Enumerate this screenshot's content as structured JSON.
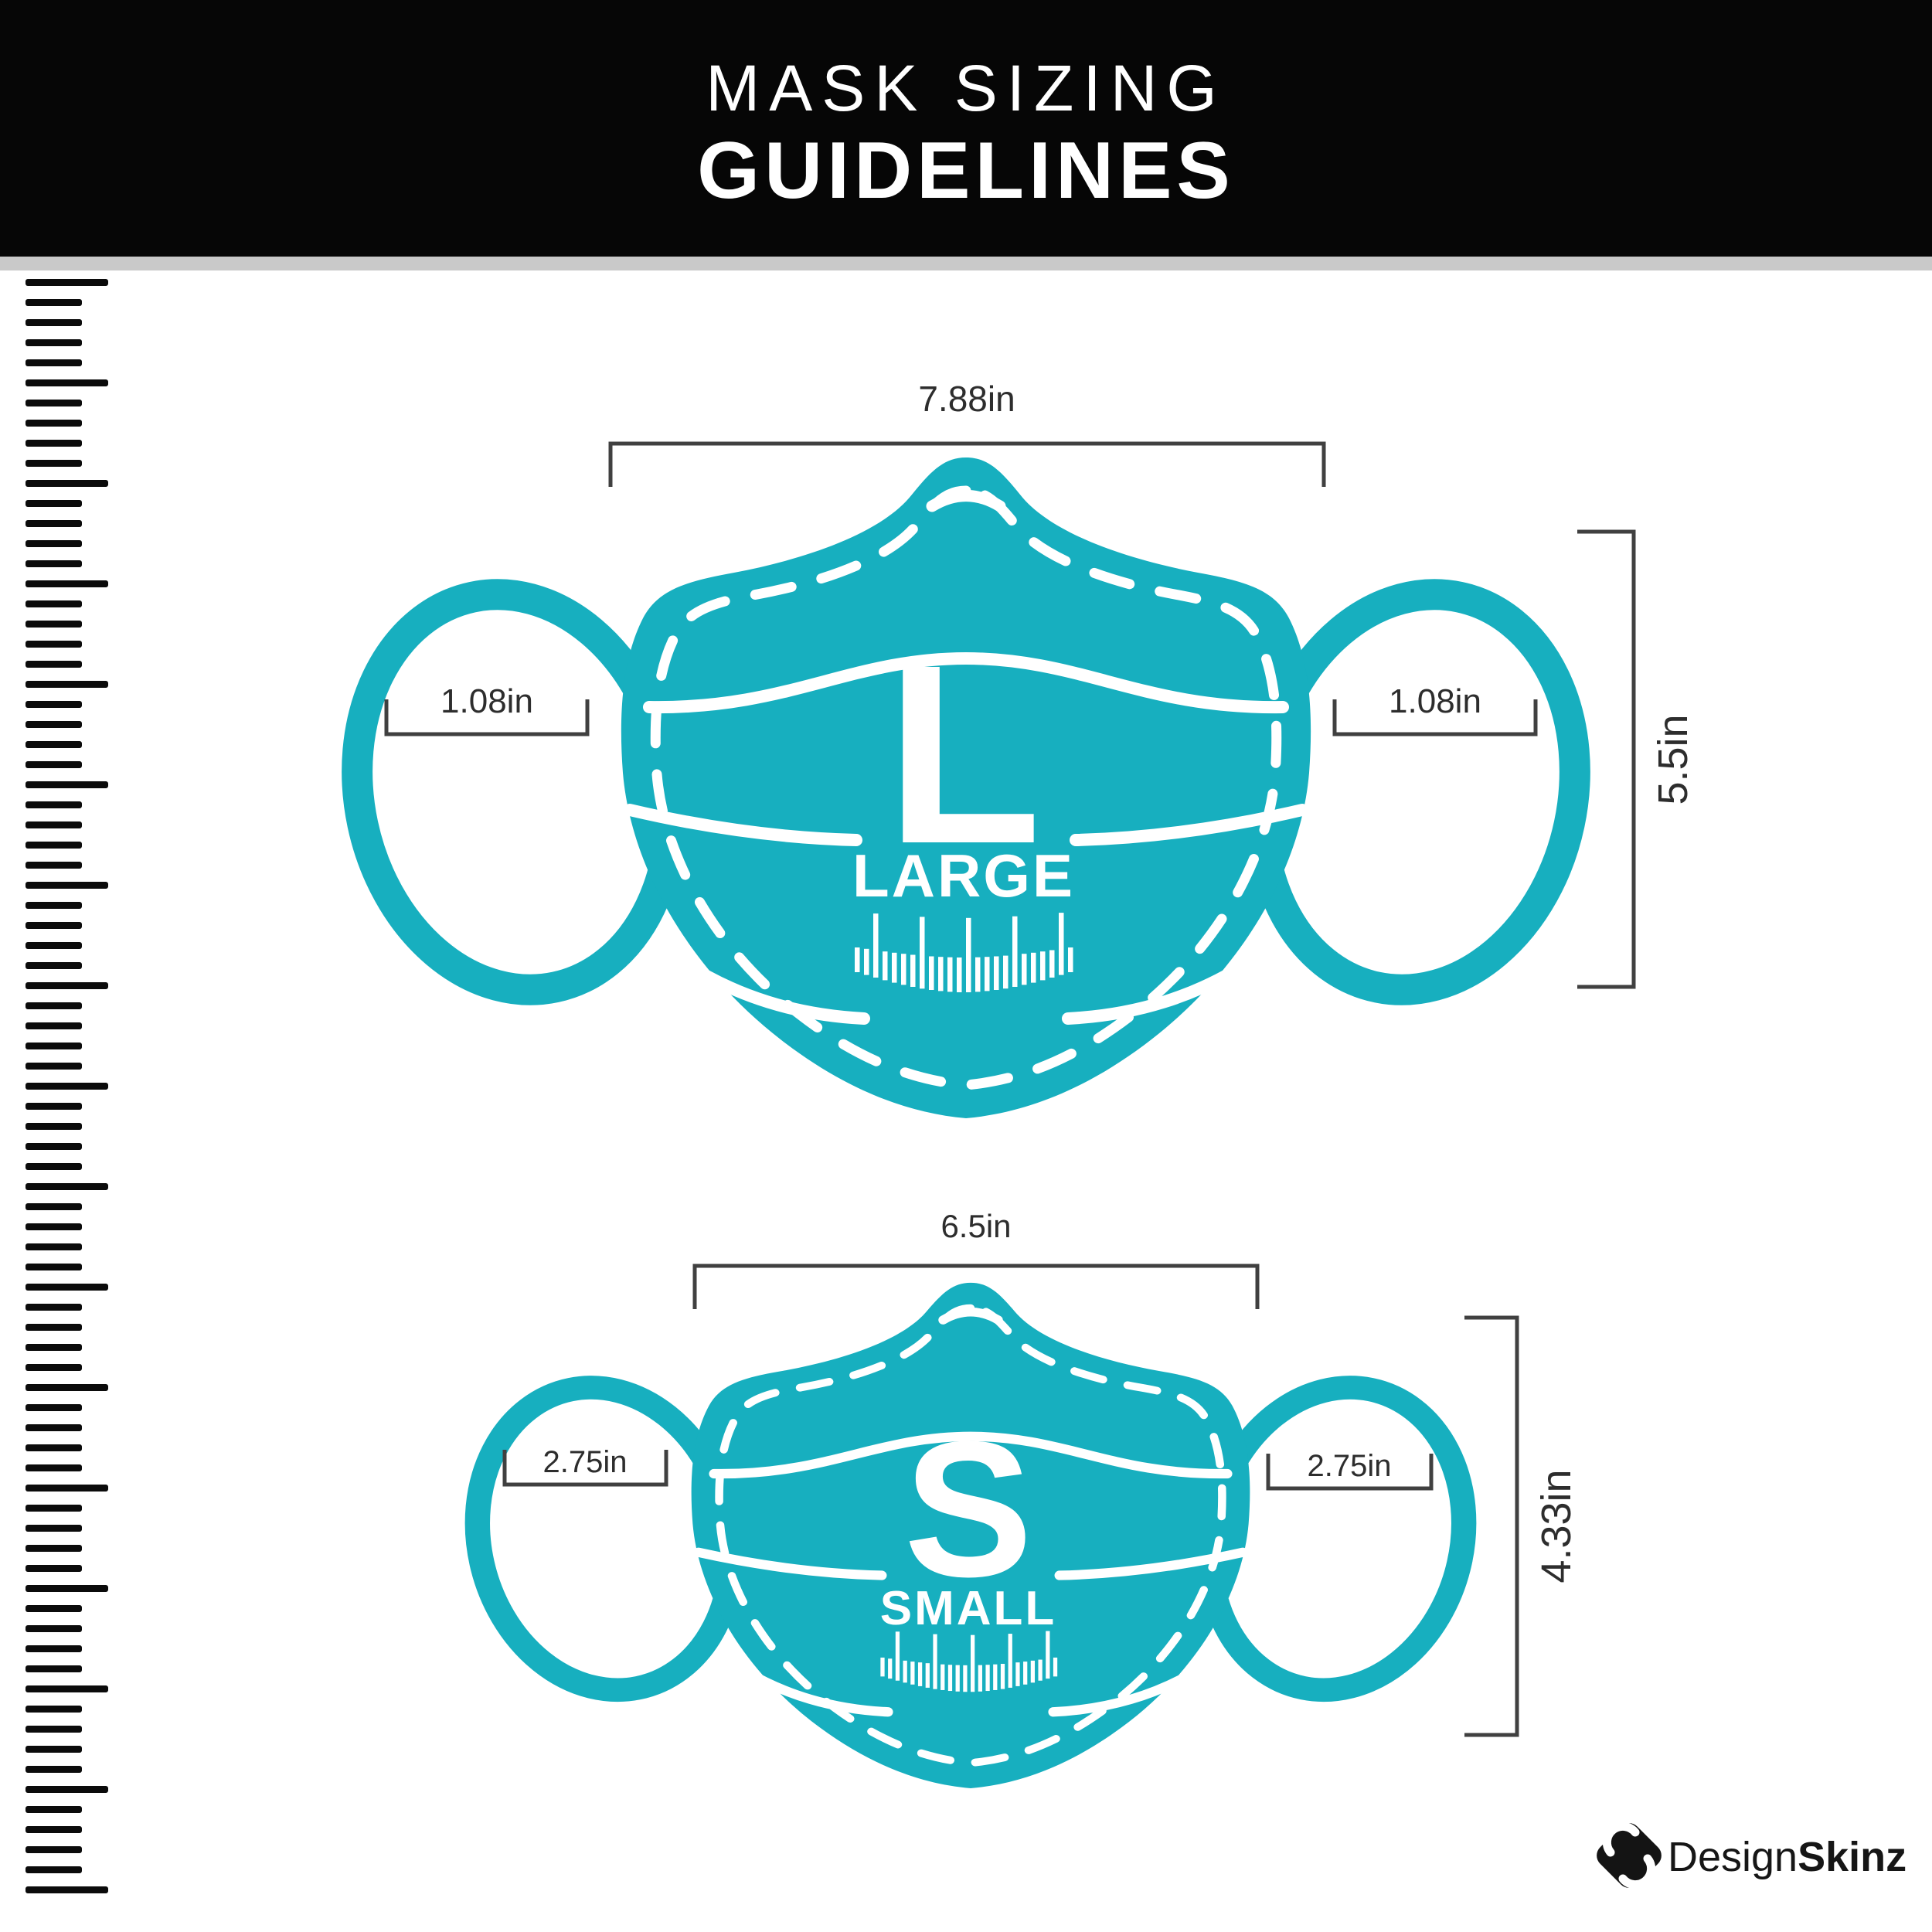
{
  "header": {
    "title_line1": "MASK SIZING",
    "title_line2": "GUIDELINES"
  },
  "masks": {
    "large": {
      "letter": "L",
      "name": "LARGE",
      "width_label": "7.88in",
      "height_label": "5.5in",
      "ear_left_label": "1.08in",
      "ear_right_label": "1.08in"
    },
    "small": {
      "letter": "S",
      "name": "SMALL",
      "width_label": "6.5in",
      "height_label": "4.33in",
      "ear_left_label": "2.75in",
      "ear_right_label": "2.75in"
    }
  },
  "logo": {
    "brand_regular": "Design",
    "brand_bold": "Skinz",
    "icon": "designskinz-diamond-s-icon"
  },
  "colors": {
    "mask_teal": "#17AFBF",
    "header_bg": "#060606",
    "divider_gray": "#C9C9C9",
    "dimension_line": "#404040",
    "text_dark": "#2D2D2D",
    "ruler_black": "#0B0B0B"
  }
}
